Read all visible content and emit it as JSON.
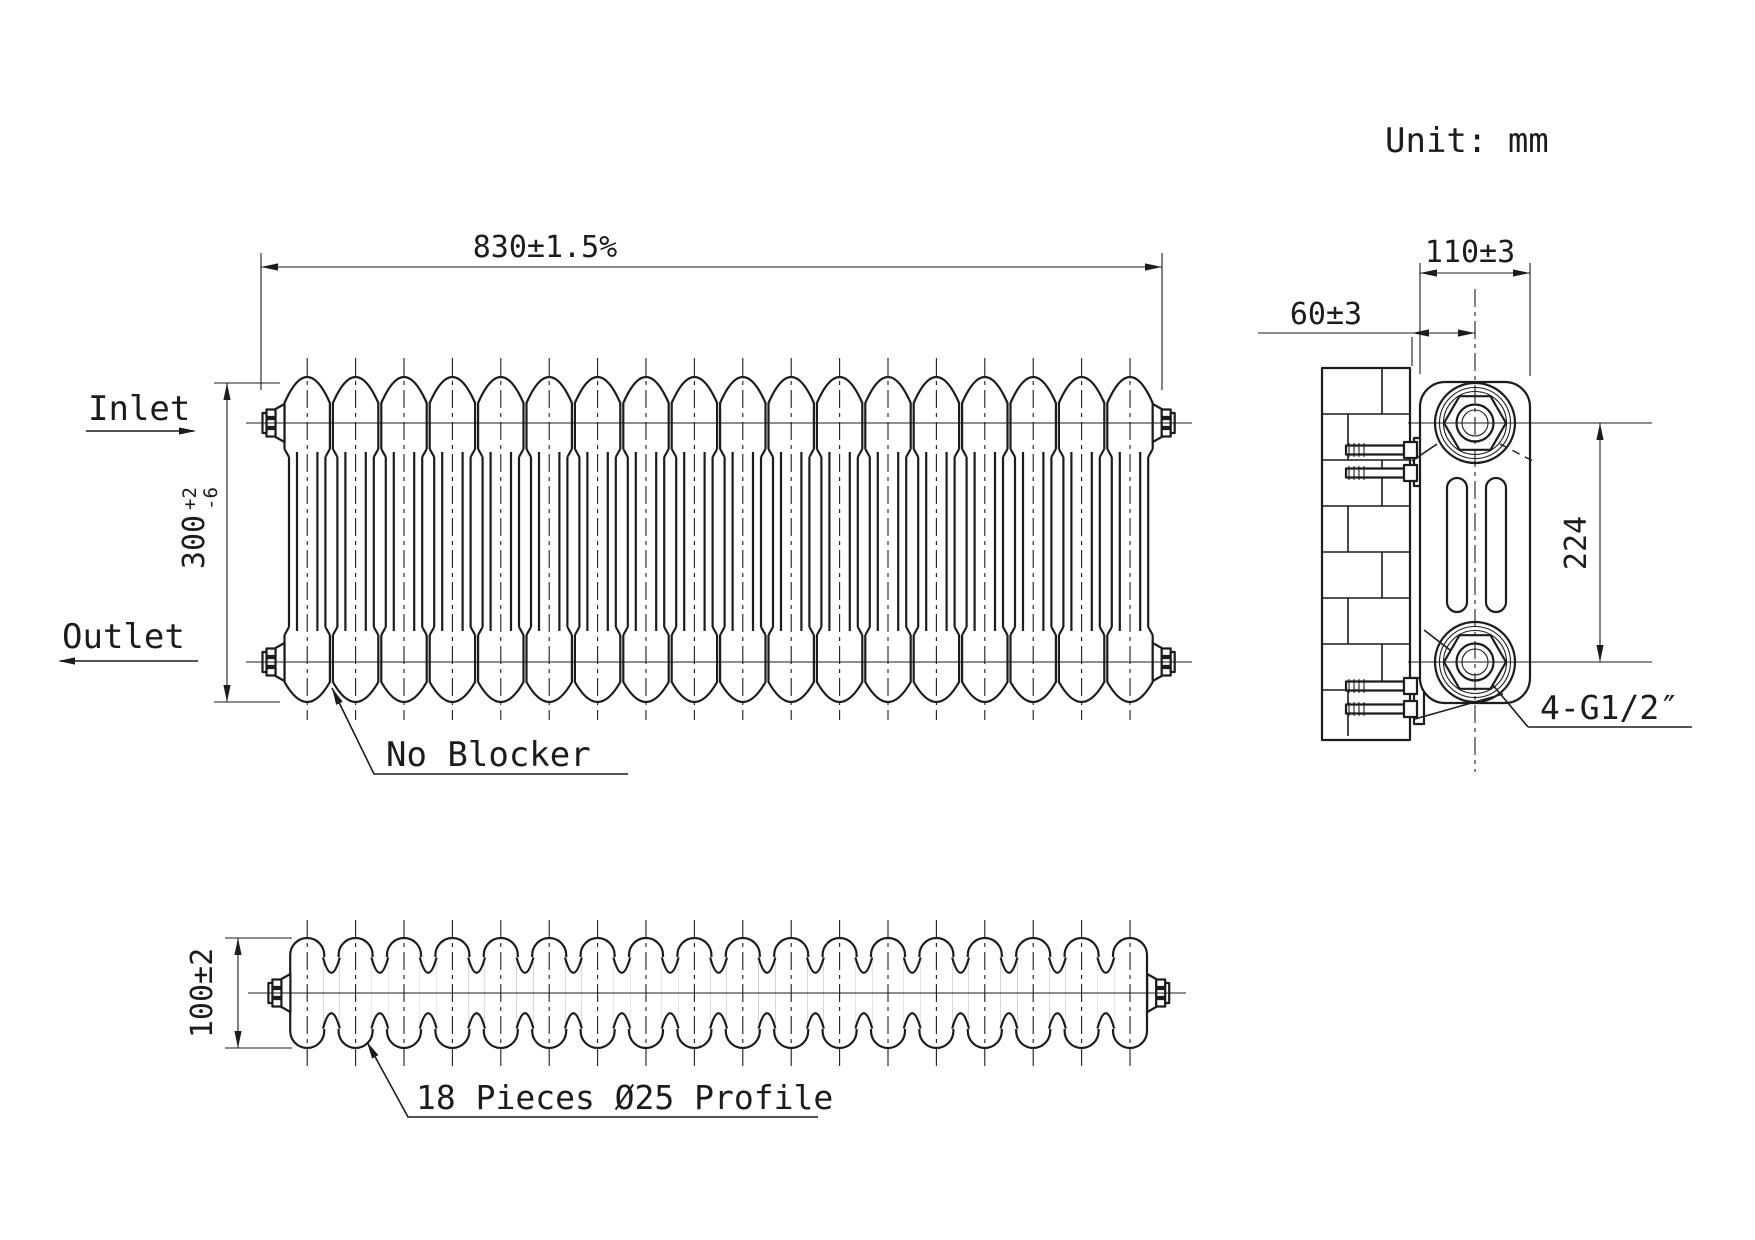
{
  "meta": {
    "unit_label": "Unit: mm",
    "line_color": "#1c1c1c",
    "background": "#ffffff"
  },
  "front_view": {
    "column_count": 18,
    "labels": {
      "inlet": "Inlet",
      "outlet": "Outlet",
      "no_blocker": "No Blocker"
    },
    "dimensions": {
      "width": "830±1.5%",
      "height": {
        "value": "300",
        "tol_plus": "+2",
        "tol_minus": "-6"
      }
    }
  },
  "plan_view": {
    "section_count": 18,
    "dimensions": {
      "depth": "100±2"
    },
    "leader": "18 Pieces Ø25 Profile"
  },
  "side_view": {
    "dimensions": {
      "depth": "110±3",
      "wall_to_pipe_center": "60±3",
      "pipe_spacing": "224"
    },
    "connection_label": "4-G1/2″"
  }
}
